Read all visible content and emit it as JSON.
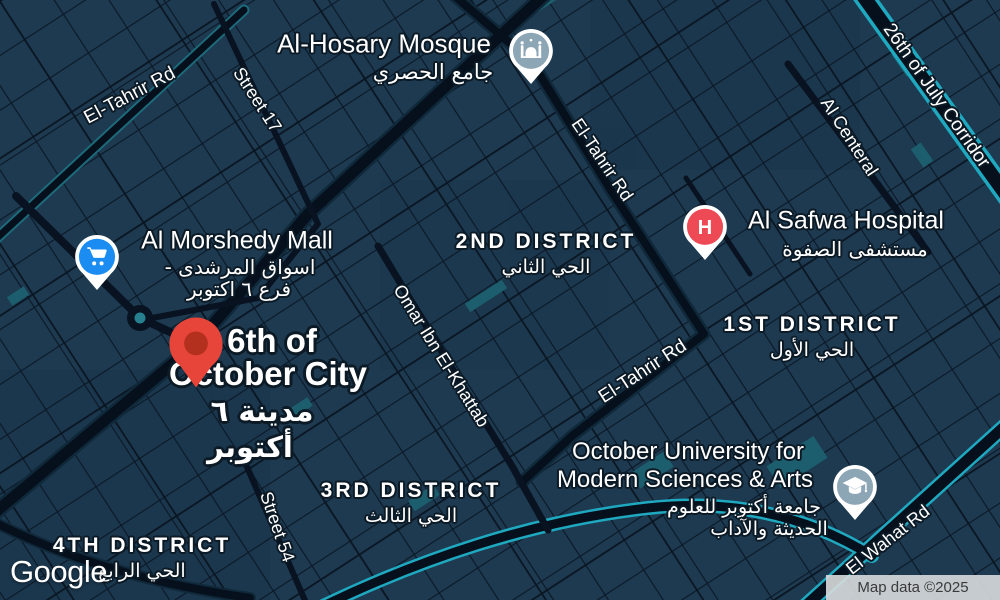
{
  "map": {
    "provider_logo": "Google",
    "attribution": "Map data ©2025",
    "colors": {
      "background": "#1d3a50",
      "road": "#05101c",
      "road_casing_cyan": "#1fa9c0",
      "teal_patch": "#1c5e6d",
      "roundabout_teal": "#27808f",
      "marker_red": "#e8453a",
      "marker_red_inner": "#b3301f",
      "poi_slate": "#8da6b5",
      "poi_hospital_red": "#ee4a55",
      "poi_mall_blue": "#1b8df2"
    },
    "city": {
      "name_line1": "6th of",
      "name_line2": "October City",
      "name_ar_line1": "مدينة ٦",
      "name_ar_line2": "أكتوبر"
    },
    "pois": {
      "mosque": {
        "name": "Al-Hosary Mosque",
        "name_ar": "جامع الحصري"
      },
      "hospital": {
        "name": "Al Safwa Hospital",
        "name_ar": "مستشفى الصفوة",
        "icon_letter": "H"
      },
      "mall": {
        "name": "Al Morshedy Mall",
        "name_ar_line1": "اسواق المرشدى -",
        "name_ar_line2": "فرع ٦ اكتوبر"
      },
      "university": {
        "name_line1": "October University for",
        "name_line2": "Modern Sciences & Arts",
        "name_ar_line1": "جامعة أكتوبر للعلوم",
        "name_ar_line2": "الحديثة والآداب"
      }
    },
    "districts": {
      "second": {
        "en": "2ND DISTRICT",
        "ar": "الحي الثاني"
      },
      "first": {
        "en": "1ST DISTRICT",
        "ar": "الحي الأول"
      },
      "third": {
        "en": "3RD DISTRICT",
        "ar": "الحي الثالث"
      },
      "fourth": {
        "en": "4TH DISTRICT",
        "ar": "الحي الرابع"
      }
    },
    "roads": {
      "el_tahrir_west": "El-Tahrir Rd",
      "street_17": "Street 17",
      "corridor_26_july": "26th of July Corridor",
      "al_centeral": "Al Centeral",
      "el_tahrir_north": "El-Tahrir Rd",
      "omar_ibn_el_khattab": "Omar Ibn El-Khattab",
      "el_tahrir_mid": "El-Tahrir Rd",
      "street_54": "Street 54",
      "el_wahat": "El Wahat Rd"
    }
  }
}
